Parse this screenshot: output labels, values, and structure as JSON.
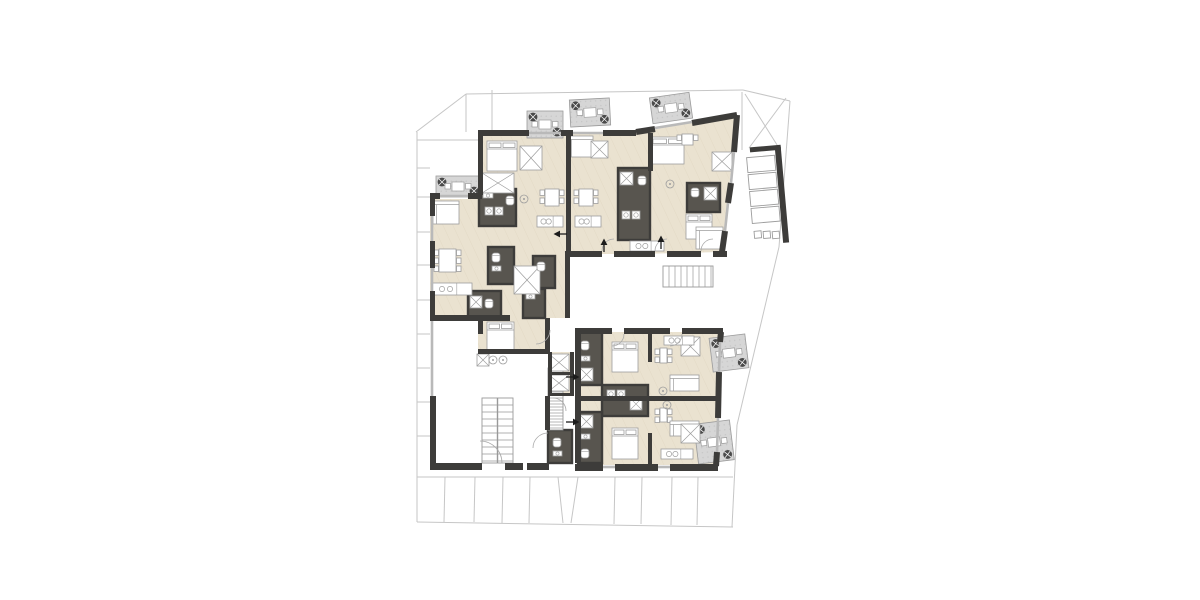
{
  "plan": {
    "palette": {
      "bg": "#ffffff",
      "wall": "#3d3c3a",
      "floor": "#eae2d0",
      "floor_line": "#ddd2bc",
      "core": "#58554f",
      "balcony": "#d6d6d6",
      "balcony_edge": "#9a9a9a",
      "plant": "#4a4a4a",
      "site": "#c6c6c6",
      "furniture": "#9d9d9d",
      "fixture_fill": "#ffffff",
      "window": "#b9b9b9",
      "stair_edge": "#999999",
      "arrow": "#1c1c1c"
    },
    "site_lines": [
      [
        416,
        132,
        466,
        94
      ],
      [
        466,
        94,
        743,
        90
      ],
      [
        466,
        94,
        466,
        132
      ],
      [
        417,
        140,
        492,
        140
      ],
      [
        492,
        90,
        492,
        140
      ],
      [
        417,
        132,
        417,
        522
      ],
      [
        417,
        522,
        733,
        527
      ],
      [
        743,
        90,
        790,
        101
      ],
      [
        790,
        101,
        779,
        247
      ],
      [
        779,
        247,
        737,
        425
      ],
      [
        737,
        425,
        732,
        527
      ],
      [
        742,
        92,
        742,
        150
      ],
      [
        745,
        94,
        779,
        148
      ],
      [
        786,
        98,
        749,
        148
      ],
      [
        417,
        168,
        430,
        168
      ],
      [
        417,
        197,
        430,
        197
      ],
      [
        417,
        232,
        430,
        232
      ],
      [
        417,
        265,
        430,
        265
      ],
      [
        417,
        300,
        430,
        300
      ],
      [
        417,
        334,
        430,
        334
      ],
      [
        417,
        368,
        430,
        368
      ],
      [
        417,
        402,
        430,
        402
      ],
      [
        417,
        436,
        430,
        436
      ],
      [
        417,
        477,
        733,
        477
      ],
      [
        445,
        477,
        444,
        522
      ],
      [
        475,
        477,
        474,
        522
      ],
      [
        503,
        477,
        502,
        523
      ],
      [
        530,
        477,
        529,
        523
      ],
      [
        558,
        477,
        563,
        523
      ],
      [
        578,
        477,
        571,
        523
      ],
      [
        615,
        477,
        614,
        524
      ],
      [
        642,
        477,
        641,
        524
      ],
      [
        672,
        477,
        671,
        525
      ],
      [
        698,
        477,
        697,
        525
      ]
    ],
    "floors": [
      {
        "points": "430,199 478,199 478,133 636,133 636,254 565,254 565,318 548,318 548,352 478,352 478,318 430,318"
      },
      {
        "points": "636,133 737,114 722,252 636,254"
      },
      {
        "points": "578,332 721,332 716,465 578,465"
      },
      {
        "points": "548,352 572,352 572,395 548,395"
      }
    ],
    "balconies": [
      {
        "x": 436,
        "y": 176,
        "w": 44,
        "h": 21,
        "rot": 0
      },
      {
        "x": 527,
        "y": 111,
        "w": 36,
        "h": 27,
        "rot": 0
      },
      {
        "x": 570,
        "y": 99,
        "w": 40,
        "h": 27,
        "rot": -3
      },
      {
        "x": 651,
        "y": 95,
        "w": 40,
        "h": 26,
        "rot": -8
      },
      {
        "x": 711,
        "y": 336,
        "w": 36,
        "h": 34,
        "rot": -7
      },
      {
        "x": 696,
        "y": 422,
        "w": 36,
        "h": 40,
        "rot": -7
      }
    ],
    "cores": [
      [
        479,
        189,
        37,
        37
      ],
      [
        488,
        247,
        26,
        37
      ],
      [
        468,
        291,
        33,
        28
      ],
      [
        523,
        289,
        22,
        29
      ],
      [
        533,
        256,
        22,
        32
      ],
      [
        618,
        168,
        32,
        72
      ],
      [
        687,
        183,
        33,
        29
      ],
      [
        578,
        332,
        24,
        53
      ],
      [
        602,
        385,
        46,
        31
      ],
      [
        578,
        412,
        24,
        51
      ],
      [
        548,
        430,
        24,
        33
      ]
    ],
    "walls": [
      [
        478,
        130,
        51,
        6
      ],
      [
        561,
        130,
        12,
        6
      ],
      [
        603,
        130,
        33,
        6
      ],
      [
        430,
        193,
        10,
        6
      ],
      [
        468,
        193,
        14,
        6
      ],
      [
        478,
        133,
        5,
        62
      ],
      [
        430,
        199,
        5,
        17
      ],
      [
        430,
        241,
        5,
        27
      ],
      [
        430,
        291,
        5,
        30
      ],
      [
        430,
        315,
        80,
        6
      ],
      [
        430,
        396,
        6,
        67
      ],
      [
        430,
        463,
        52,
        7
      ],
      [
        566,
        133,
        5,
        118
      ],
      [
        648,
        133,
        5,
        38
      ],
      [
        565,
        251,
        37,
        6
      ],
      [
        614,
        251,
        41,
        6
      ],
      [
        667,
        251,
        34,
        6
      ],
      [
        713,
        251,
        14,
        6
      ],
      [
        565,
        254,
        5,
        64
      ],
      [
        545,
        318,
        5,
        36
      ],
      [
        545,
        396,
        5,
        34
      ],
      [
        478,
        349,
        72,
        5
      ],
      [
        478,
        320,
        5,
        14
      ],
      [
        505,
        463,
        18,
        7
      ],
      [
        527,
        463,
        22,
        7
      ],
      [
        575,
        328,
        37,
        6
      ],
      [
        624,
        328,
        46,
        6
      ],
      [
        682,
        328,
        41,
        6
      ],
      [
        575,
        334,
        6,
        62
      ],
      [
        575,
        401,
        6,
        62
      ],
      [
        575,
        396,
        146,
        5
      ],
      [
        575,
        464,
        28,
        7
      ],
      [
        615,
        464,
        43,
        7
      ],
      [
        670,
        464,
        48,
        7
      ],
      [
        548,
        352,
        4,
        44
      ],
      [
        570,
        352,
        4,
        44
      ],
      [
        548,
        372,
        26,
        3
      ],
      [
        548,
        393,
        26,
        3
      ],
      [
        648,
        332,
        4,
        30
      ],
      [
        648,
        433,
        4,
        31
      ]
    ],
    "wall_lines": [
      [
        636,
        132,
        655,
        129
      ],
      [
        692,
        123,
        737,
        115
      ],
      [
        737,
        115,
        734,
        152
      ],
      [
        731,
        183,
        728,
        203
      ],
      [
        725,
        231,
        722,
        252
      ],
      [
        721,
        332,
        720,
        342
      ],
      [
        719,
        372,
        718,
        418
      ],
      [
        717,
        452,
        716,
        466
      ]
    ],
    "windows": [
      [
        529,
        133,
        561,
        133
      ],
      [
        573,
        133,
        603,
        133
      ],
      [
        440,
        196,
        468,
        196
      ],
      [
        432,
        216,
        432,
        241
      ],
      [
        432,
        268,
        432,
        291
      ],
      [
        432,
        321,
        432,
        396
      ],
      [
        655,
        128,
        692,
        122
      ],
      [
        734,
        152,
        731,
        183
      ],
      [
        728,
        203,
        725,
        231
      ],
      [
        603,
        467,
        615,
        467
      ],
      [
        658,
        467,
        670,
        467
      ],
      [
        720,
        342,
        719,
        372
      ],
      [
        718,
        418,
        717,
        452
      ]
    ],
    "stairs": [
      {
        "x": 663,
        "y": 266,
        "w": 50,
        "h": 21,
        "dir": "v",
        "step": 6,
        "rail": false
      },
      {
        "x": 548,
        "y": 368,
        "w": 15,
        "h": 62,
        "dir": "h",
        "step": 3,
        "rail": false
      },
      {
        "x": 482,
        "y": 398,
        "w": 31,
        "h": 65,
        "dir": "h",
        "step": 7,
        "rail": true
      }
    ],
    "doors": [
      "M602,251 A12 12 0 0 1 614,239",
      "M655,251 A12 12 0 0 1 667,239",
      "M701,251 A12 12 0 0 1 713,239",
      "M624,334 A12 12 0 0 1 612,346",
      "M682,334 A12 12 0 0 1 670,346",
      "M502,463 A22 22 0 0 0 480,441",
      "M550,330 A14 14 0 0 1 536,344",
      "M553,398 A13 13 0 0 1 566,411",
      "M533,448 A15 15 0 0 1 548,433"
    ],
    "arrows": [
      [
        558,
        234,
        "left"
      ],
      [
        604,
        243,
        "up"
      ],
      [
        661,
        240,
        "up"
      ],
      [
        575,
        377,
        "right"
      ],
      [
        575,
        422,
        "right"
      ]
    ],
    "parking": {
      "rot": -5,
      "cx": 768,
      "cy": 196,
      "walls": [
        [
          779,
          148,
          6,
          96
        ],
        [
          754,
          146,
          31,
          5
        ]
      ],
      "stalls": [
        [
          750,
          156,
          28,
          15
        ],
        [
          750,
          173,
          28,
          15
        ],
        [
          750,
          190,
          28,
          15
        ],
        [
          750,
          207,
          28,
          15
        ]
      ],
      "bins": [
        [
          751,
          230,
          7,
          7
        ],
        [
          760,
          231,
          7,
          7
        ],
        [
          769,
          232,
          7,
          7
        ]
      ]
    },
    "furniture": [
      [
        "bed",
        487,
        141,
        30,
        30
      ],
      [
        "wardrobe",
        482,
        173,
        32,
        20
      ],
      [
        "wardrobe",
        520,
        146,
        22,
        24
      ],
      [
        "sofa",
        433,
        201,
        26,
        23
      ],
      [
        "table",
        434,
        246,
        27,
        29,
        "v"
      ],
      [
        "kitchen",
        432,
        283,
        40,
        12,
        "h"
      ],
      [
        "bed",
        487,
        322,
        27,
        28
      ],
      [
        "wardrobe",
        514,
        266,
        26,
        28
      ],
      [
        "sofa",
        568,
        136,
        25,
        21
      ],
      [
        "wardrobe",
        591,
        141,
        17,
        17
      ],
      [
        "table",
        540,
        186,
        24,
        23,
        "v"
      ],
      [
        "table",
        574,
        186,
        24,
        23,
        "v"
      ],
      [
        "kitchen",
        537,
        216,
        26,
        11,
        "h"
      ],
      [
        "kitchen",
        575,
        216,
        26,
        11,
        "h"
      ],
      [
        "lamp",
        524,
        199
      ],
      [
        "lamp",
        670,
        184
      ],
      [
        "bed",
        651,
        137,
        33,
        27
      ],
      [
        "table",
        677,
        131,
        21,
        17,
        "v"
      ],
      [
        "bed",
        686,
        214,
        26,
        25
      ],
      [
        "sofa",
        696,
        227,
        27,
        22
      ],
      [
        "kitchen",
        630,
        241,
        34,
        10,
        "h"
      ],
      [
        "wardrobe",
        712,
        152,
        20,
        19
      ],
      [
        "shower",
        704,
        187,
        13,
        13
      ],
      [
        "wc",
        691,
        188,
        8,
        9
      ],
      [
        "washer",
        485,
        207,
        8,
        8
      ],
      [
        "washer",
        495,
        207,
        8,
        8
      ],
      [
        "wc",
        506,
        196,
        8,
        9
      ],
      [
        "sink",
        483,
        193,
        10,
        5
      ],
      [
        "shower",
        620,
        172,
        13,
        13
      ],
      [
        "wc",
        638,
        176,
        8,
        9
      ],
      [
        "washer",
        622,
        211,
        8,
        8
      ],
      [
        "washer",
        632,
        211,
        8,
        8
      ],
      [
        "wc",
        492,
        253,
        8,
        9
      ],
      [
        "sink",
        492,
        266,
        9,
        5
      ],
      [
        "shower",
        470,
        296,
        12,
        12
      ],
      [
        "wc",
        485,
        299,
        8,
        9
      ],
      [
        "wc",
        537,
        262,
        8,
        9
      ],
      [
        "sink",
        526,
        294,
        9,
        5
      ],
      [
        "bed",
        612,
        342,
        26,
        30
      ],
      [
        "wardrobe",
        681,
        337,
        19,
        19
      ],
      [
        "table",
        655,
        345,
        17,
        21,
        "v"
      ],
      [
        "sofa",
        670,
        375,
        29,
        16
      ],
      [
        "kitchen",
        664,
        336,
        30,
        9,
        "h"
      ],
      [
        "lamp",
        663,
        391
      ],
      [
        "bed",
        612,
        428,
        26,
        31
      ],
      [
        "table",
        655,
        405,
        17,
        20,
        "v"
      ],
      [
        "sofa",
        670,
        421,
        29,
        15
      ],
      [
        "kitchen",
        661,
        449,
        32,
        10,
        "h"
      ],
      [
        "wardrobe",
        681,
        424,
        19,
        19
      ],
      [
        "lamp",
        667,
        405
      ],
      [
        "wc",
        581,
        341,
        8,
        9
      ],
      [
        "sink",
        581,
        356,
        9,
        5
      ],
      [
        "shower",
        580,
        368,
        13,
        13
      ],
      [
        "shower",
        580,
        415,
        13,
        13
      ],
      [
        "sink",
        581,
        434,
        9,
        5
      ],
      [
        "wc",
        581,
        449,
        8,
        9
      ],
      [
        "washer",
        607,
        390,
        8,
        8
      ],
      [
        "washer",
        617,
        390,
        8,
        8
      ],
      [
        "shower",
        630,
        398,
        12,
        12
      ],
      [
        "wc",
        553,
        438,
        8,
        9
      ],
      [
        "sink",
        553,
        451,
        9,
        5
      ],
      [
        "wardrobe",
        549,
        354,
        20,
        17
      ],
      [
        "wardrobe",
        549,
        375,
        20,
        16
      ],
      [
        "shower",
        477,
        354,
        12,
        12
      ],
      [
        "lamp",
        493,
        360
      ],
      [
        "lamp",
        503,
        360
      ]
    ]
  }
}
